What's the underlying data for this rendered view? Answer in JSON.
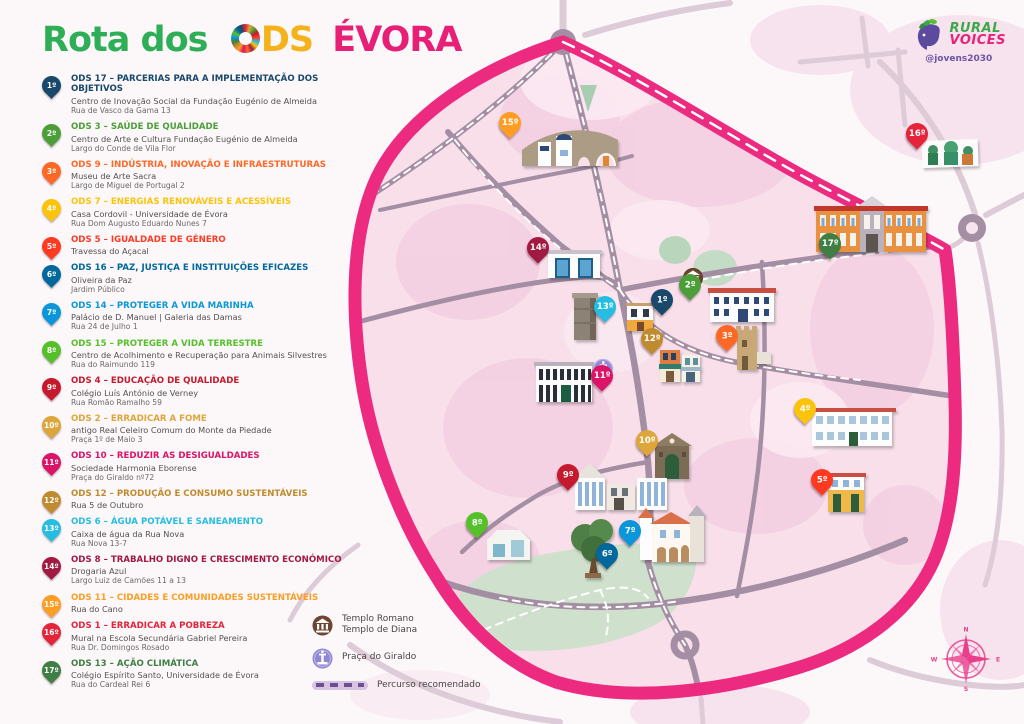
{
  "title": {
    "part1": "Rota dos",
    "ods_o_icon": "sdg-color-wheel",
    "part2": "DS",
    "part3": "ÉVORA"
  },
  "logo": {
    "line1": "RURAL",
    "line2": "VOICES",
    "handle": "@jovens2030",
    "icon": "head-with-leaves"
  },
  "colors": {
    "route_pink": "#ec2a80",
    "map_inner_pink": "#f8dfe9",
    "blob_pink": "#f3cde0",
    "road_inner": "#a48ea4",
    "road_outer": "#ddcbd7",
    "park_green": "#cfe0cd",
    "title_green": "#2fae58",
    "title_yellow": "#f6b21b",
    "title_pink": "#e81f76",
    "legend_dash_bg": "#d6c4e0",
    "legend_dash": "#6b4f93"
  },
  "stops": [
    {
      "num": "1º",
      "color": "#19486A",
      "heading": "ODS 17 – PARCERIAS PARA A IMPLEMENTAÇÃO DOS OBJETIVOS",
      "name": "Centro de Inovação Social da Fundação Eugénio de Almeida",
      "address": "Rua de Vasco da Gama 13",
      "map_x": 662,
      "map_y": 315
    },
    {
      "num": "2º",
      "color": "#4C9F38",
      "heading": "ODS 3 – SAÚDE DE QUALIDADE",
      "name": "Centro de Arte e Cultura Fundação Eugénio de Almeida",
      "address": "Largo do Conde de Vila Flor",
      "map_x": 690,
      "map_y": 300
    },
    {
      "num": "3º",
      "color": "#FD6925",
      "heading": "ODS 9 – INDÚSTRIA, INOVAÇÃO E INFRAESTRUTURAS",
      "name": "Museu de Arte Sacra",
      "address": "Largo de Miguel de Portugal 2",
      "map_x": 727,
      "map_y": 351
    },
    {
      "num": "4º",
      "color": "#FCC30B",
      "heading": "ODS 7 – ENERGIAS RENOVÁVEIS E ACESSÍVEIS",
      "name": "Casa Cordovil - Universidade de Évora",
      "address": "Rua Dom Augusto Eduardo Nunes 7",
      "map_x": 805,
      "map_y": 424
    },
    {
      "num": "5º",
      "color": "#FF3A21",
      "heading": "ODS 5 – IGUALDADE DE GÉNERO",
      "name": "Travessa do Açacal",
      "address": "",
      "map_x": 822,
      "map_y": 495
    },
    {
      "num": "6º",
      "color": "#00689D",
      "heading": "ODS 16 – PAZ, JUSTIÇA E INSTITUIÇÕES EFICAZES",
      "name": "Oliveira da Paz",
      "address": "Jardim Público",
      "map_x": 607,
      "map_y": 569
    },
    {
      "num": "7º",
      "color": "#0A97D9",
      "heading": "ODS 14 – PROTEGER A VIDA MARINHA",
      "name": "Palácio de D. Manuel | Galeria das Damas",
      "address": "Rua 24 de Julho 1",
      "map_x": 630,
      "map_y": 546
    },
    {
      "num": "8º",
      "color": "#56C02B",
      "heading": "ODS 15 – PROTEGER A VIDA TERRESTRE",
      "name": "Centro de Acolhimento e Recuperação para Animais Silvestres",
      "address": "Rua do Raimundo 119",
      "map_x": 477,
      "map_y": 538
    },
    {
      "num": "9º",
      "color": "#C5192D",
      "heading": "ODS 4 – EDUCAÇÃO DE QUALIDADE",
      "name": "Colégio Luís António de Verney",
      "address": "Rua Romão Ramalho 59",
      "map_x": 568,
      "map_y": 490
    },
    {
      "num": "10º",
      "color": "#DDA63A",
      "heading": "ODS 2 – ERRADICAR A FOME",
      "name": "antigo Real Celeiro Comum do Monte da Piedade",
      "address": "Praça 1º de Maio 3",
      "map_x": 647,
      "map_y": 456
    },
    {
      "num": "11º",
      "color": "#DD1367",
      "heading": "ODS 10 – REDUZIR AS DESIGUALDADES",
      "name": "Sociedade Harmonia Eborense",
      "address": "Praça do Giraldo nº72",
      "map_x": 602,
      "map_y": 391
    },
    {
      "num": "12º",
      "color": "#BF8B2E",
      "heading": "ODS 12 – PRODUÇÃO E CONSUMO SUSTENTÁVEIS",
      "name": "Rua 5 de Outubro",
      "address": "",
      "map_x": 652,
      "map_y": 354
    },
    {
      "num": "13º",
      "color": "#26BDE2",
      "heading": "ODS 6 – ÁGUA POTÁVEL E SANEAMENTO",
      "name": "Caixa de água da Rua Nova",
      "address": "Rua Nova 13-7",
      "map_x": 605,
      "map_y": 322
    },
    {
      "num": "14º",
      "color": "#A21942",
      "heading": "ODS 8 – TRABALHO DIGNO E CRESCIMENTO ECONÓMICO",
      "name": "Drogaria Azul",
      "address": "Largo Luiz de Camões 11 a 13",
      "map_x": 538,
      "map_y": 263
    },
    {
      "num": "15º",
      "color": "#FD9D24",
      "heading": "ODS 11 – CIDADES E COMUNIDADES SUSTENTÁVEIS",
      "name": "Rua do Cano",
      "address": "",
      "map_x": 510,
      "map_y": 138
    },
    {
      "num": "16º",
      "color": "#E5243B",
      "heading": "ODS 1 – ERRADICAR A POBREZA",
      "name": "Mural na Escola Secundária Gabriel Pereira",
      "address": "Rua Dr. Domingos Rosado",
      "map_x": 917,
      "map_y": 149
    },
    {
      "num": "17º",
      "color": "#3F7E44",
      "heading": "ODS 13 – AÇÃO CLIMÁTICA",
      "name": "Colégio Espírito Santo, Universidade de Évora",
      "address": "Rua do Cardeal Rei 6",
      "map_x": 830,
      "map_y": 259
    }
  ],
  "map_legend": {
    "temple": {
      "icon": "roman-temple",
      "line1": "Templo Romano",
      "line2": "Templo de Diana"
    },
    "giraldo": {
      "icon": "fountain",
      "label": "Praça do Giraldo"
    },
    "route": {
      "icon": "dashed-line-sample",
      "label": "Percurso recomendado"
    }
  },
  "compass": {
    "n": "N",
    "e": "E",
    "s": "S",
    "w": "W"
  }
}
